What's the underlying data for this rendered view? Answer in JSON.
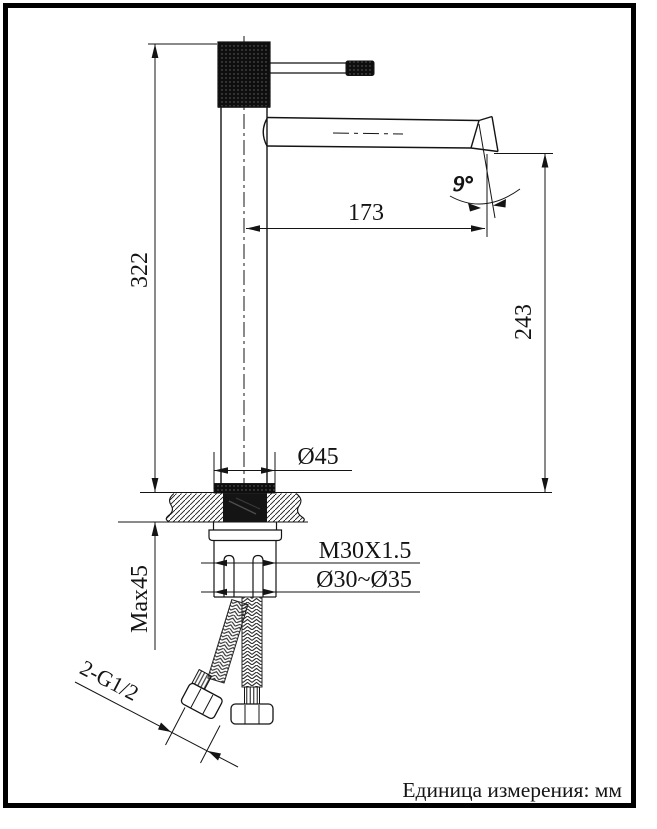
{
  "labels": {
    "overall_height": "322",
    "spout_reach": "173",
    "outlet_height": "243",
    "outlet_angle": "9°",
    "base_diameter": "Ø45",
    "mounting_thread": "M30X1.5",
    "hole_diameter_range": "Ø30~Ø35",
    "max_counter_thickness": "Max45",
    "hose_connection": "2-G1/2",
    "unit_note": "Единица измерения: мм"
  },
  "colors": {
    "line": "#141414",
    "frame": "#000000",
    "background": "#ffffff"
  }
}
